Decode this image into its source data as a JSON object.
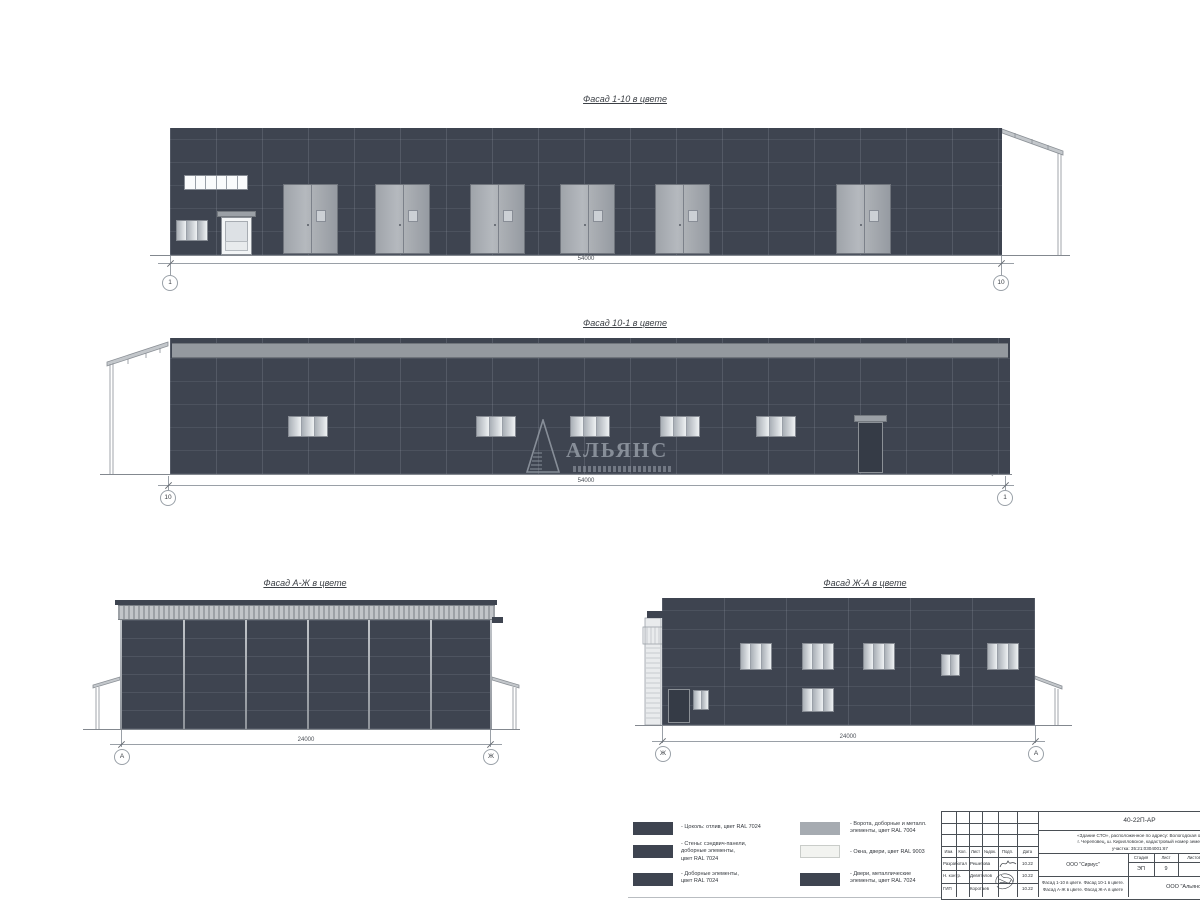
{
  "facades": {
    "f1_10": {
      "title": "Фасад 1-10 в цвете",
      "dim": "54000",
      "axis_left": "1",
      "axis_right": "10"
    },
    "f10_1": {
      "title": "Фасад 10-1 в цвете",
      "dim": "54000",
      "axis_left": "10",
      "axis_right": "1"
    },
    "fa_zh": {
      "title": "Фасад А-Ж в цвете",
      "dim": "24000",
      "axis_left": "А",
      "axis_right": "Ж"
    },
    "fzh_a": {
      "title": "Фасад Ж-А в цвете",
      "dim": "24000",
      "axis_left": "Ж",
      "axis_right": "А"
    }
  },
  "watermark": {
    "name": "АЛЬЯНС"
  },
  "colors": {
    "wall_ral7024": "#3e4450",
    "gates_ral7004": "#a6abb1",
    "windows_ral9003": "#f2f3f0",
    "parapet": "#94999f"
  },
  "legend": {
    "items": [
      {
        "swatch": "#3e4450",
        "label": "- Цоколь: отлив, цвет RAL 7024"
      },
      {
        "swatch": "#3e4450",
        "label": "- Стены: сэндвич-панели,\nдоборные элементы,\nцвет RAL 7024"
      },
      {
        "swatch": "#3e4450",
        "label": "- Доборные элементы,\nцвет RAL 7024"
      },
      {
        "swatch": "#a6abb1",
        "label": "- Ворота, доборные и металл.\nэлементы, цвет RAL 7004"
      },
      {
        "swatch": "#f2f3f0",
        "label": "- Окна, двери, цвет RAL 9003"
      },
      {
        "swatch": "#3e4450",
        "label": "- Двери, металлические\nэлементы, цвет RAL 7024"
      }
    ]
  },
  "stamp": {
    "code": "40-22П-АР",
    "project": "«Здание СТО», расположенное по адресу: Вологодская об\nг. Череповец, ш. Кирилловское, кадастровый номер земел\nучастка: 35:21:0304001:67",
    "cols": [
      "Изм.",
      "Кол.",
      "Лист",
      "№док.",
      "Подп.",
      "Дата"
    ],
    "rows": [
      {
        "role": "Разработал",
        "name": "Решетова",
        "date": "10.22"
      },
      {
        "role": "Н. контр.",
        "name": "Девятилов",
        "date": "10.22"
      },
      {
        "role": "ГИП",
        "name": "Коротаев",
        "date": "10.22"
      }
    ],
    "org": "ООО \"Сириус\"",
    "stage_label": "Стадия",
    "sheet_label": "Лист",
    "sheets_label": "Листов",
    "stage": "ЭП",
    "sheet": "9",
    "content": "Фасад 1-10 в цвете. Фасад 10-1 в цвете.\nФасад А-Ж в цвете. Фасад Ж-А в цвете",
    "org2": "ООО \"Альянс\""
  }
}
